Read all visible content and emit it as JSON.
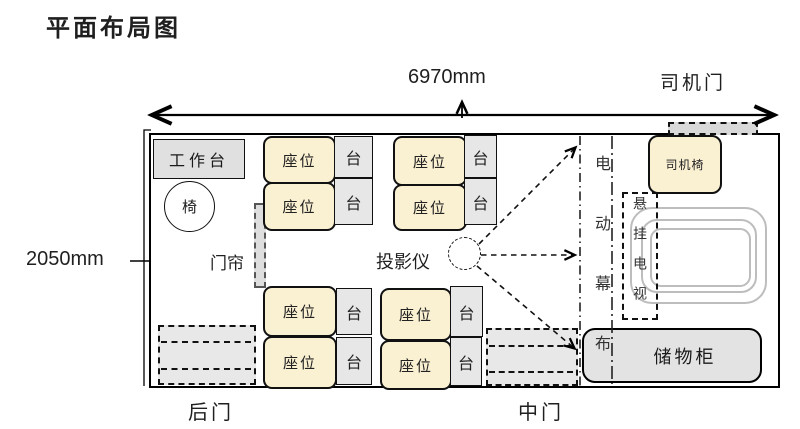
{
  "title": "平面布局图",
  "dimensions": {
    "length": "6970mm",
    "width": "2050mm"
  },
  "labels": {
    "driver_door": "司机门",
    "rear_door": "后门",
    "middle_door": "中门",
    "worktable": "工作台",
    "chair": "椅",
    "curtain": "门帘",
    "seat": "座位",
    "side_table": "台",
    "projector": "投影仪",
    "electric_screen": "电动幕布",
    "driver_seat": "司机椅",
    "hanging_tv": "悬挂电视",
    "cabinet": "储物柜"
  },
  "colors": {
    "seat_fill": "#FAF0D2",
    "furniture_fill": "#E7E7E7",
    "door_fill": "#E8E8E8",
    "outline": "#000000",
    "tv_rings": "#BDBDBD"
  }
}
